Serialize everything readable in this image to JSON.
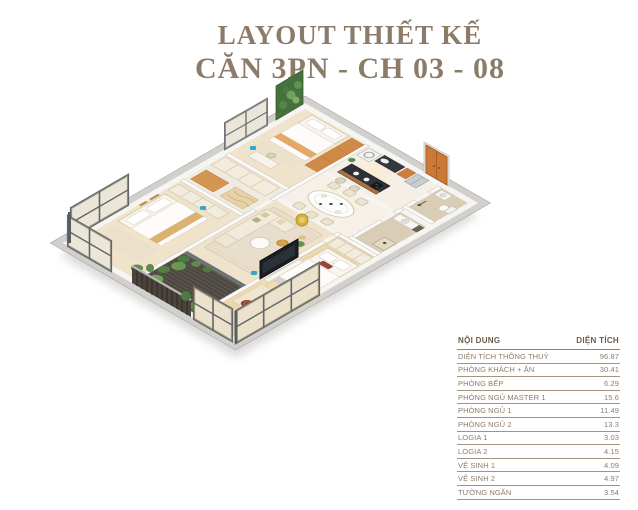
{
  "page": {
    "background": "#ffffff"
  },
  "title": {
    "line1": "LAYOUT THIẾT KẾ",
    "line2": "CĂN 3PN - CH 03 - 08",
    "color": "#8d7b6a"
  },
  "area_table": {
    "header": {
      "content": "NỘI DUNG",
      "area": "DIỆN TÍCH"
    },
    "rows": [
      {
        "label": "DIỆN TÍCH THÔNG THUỶ",
        "value": "96.87"
      },
      {
        "label": "PHÒNG KHÁCH + ĂN",
        "value": "30.41"
      },
      {
        "label": "PHÒNG BẾP",
        "value": "6.29"
      },
      {
        "label": "PHÒNG NGỦ MASTER 1",
        "value": "15.6"
      },
      {
        "label": "PHÒNG NGỦ 1",
        "value": "11.49"
      },
      {
        "label": "PHÒNG NGỦ 2",
        "value": "13.3"
      },
      {
        "label": "LOGIA 1",
        "value": "3.03"
      },
      {
        "label": "LOGIA 2",
        "value": "4.15"
      },
      {
        "label": "VỆ SINH 1",
        "value": "4.09"
      },
      {
        "label": "VỆ SINH 2",
        "value": "4.97"
      },
      {
        "label": "TƯỜNG NGĂN",
        "value": "3.54"
      }
    ],
    "text_color": "#8d7c69",
    "line_color": "#a4937d"
  },
  "floor_plan": {
    "type": "isometric-3d-apartment-render",
    "depicted_rooms": [
      "bedroom-1",
      "bedroom-2",
      "master-bedroom",
      "kitchen",
      "dining-area",
      "living-area",
      "loggia-balcony",
      "bathroom-1",
      "bathroom-2",
      "entrance-hall"
    ],
    "palette": {
      "wood_floor": "#f0e3cb",
      "master_floor": "#edd8ad",
      "wall_white": "#f6f5f2",
      "wall_cap_gray": "#d2d0cc",
      "window_frame": "#6f747a",
      "door_orange": "#c87a36",
      "plant_green": "#5d8c4e",
      "loggia_deck": "#57524b",
      "accent_wood": "#d08a48",
      "badge_gold": "#d9b13c",
      "tag_teal": "#35a7c8"
    }
  }
}
